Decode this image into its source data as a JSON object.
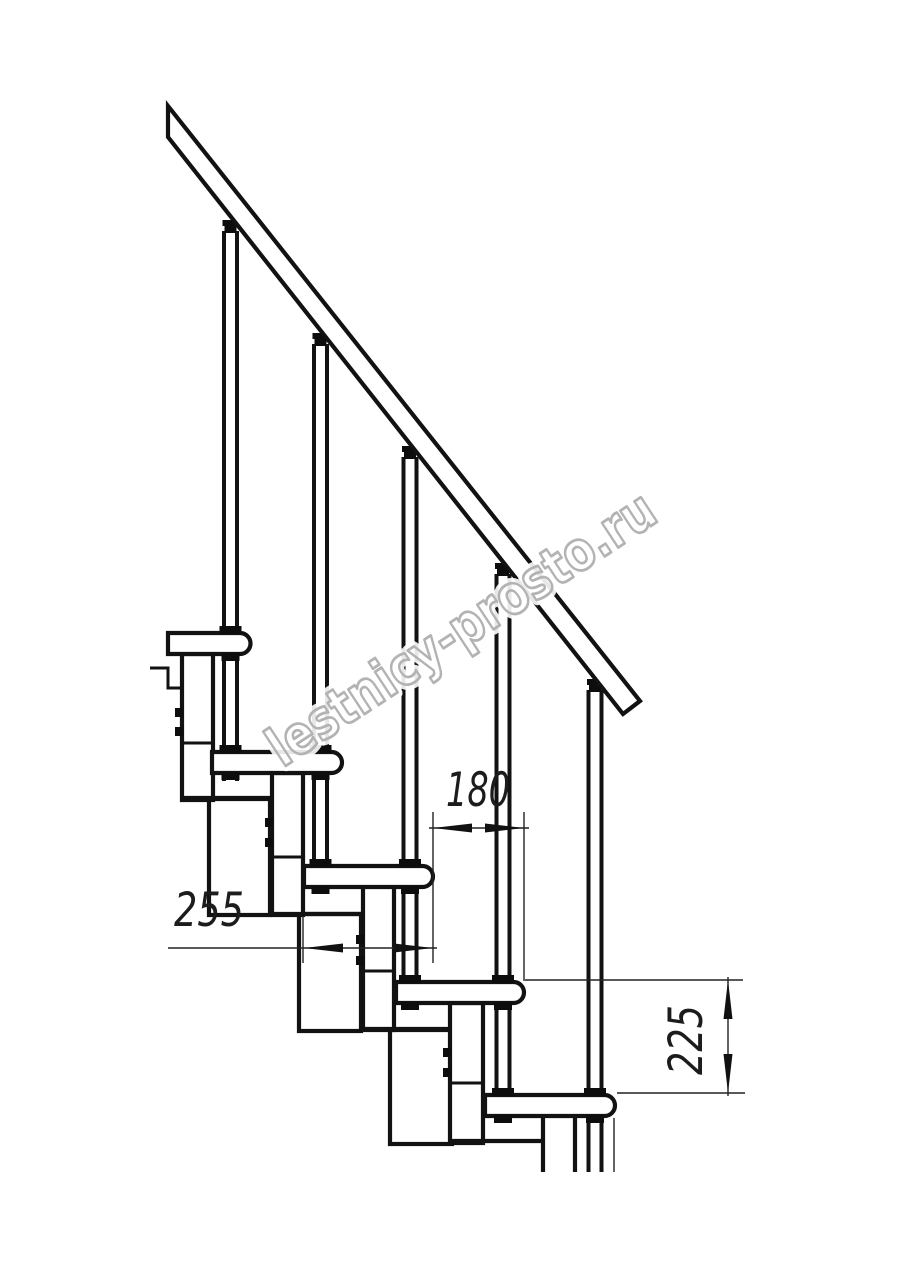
{
  "watermark": {
    "text": "lestnicy-prosto.ru",
    "color": "#b3b3b3"
  },
  "dimensions": {
    "tread_overlap": {
      "value": "180"
    },
    "tread_depth": {
      "value": "255"
    },
    "step_rise": {
      "value": "225"
    }
  },
  "drawing": {
    "colors": {
      "line": "#121212",
      "background": "#ffffff"
    },
    "tread_count": 5,
    "baluster_count": 5
  }
}
